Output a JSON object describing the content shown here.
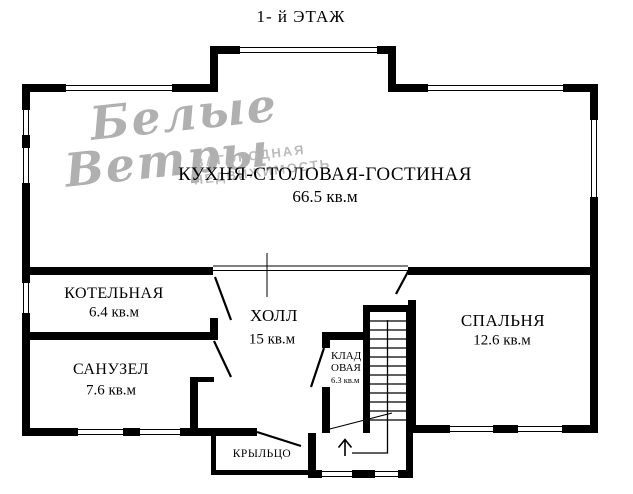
{
  "title": "1- й ЭТАЖ",
  "watermark": {
    "script_line1": "Белые",
    "script_line2": "Ветры",
    "caption_line1": "ЗАГОРОДНАЯ",
    "caption_line2": "НЕДВИЖИМОСТЬ"
  },
  "rooms": {
    "living": {
      "name": "КУХНЯ-СТОЛОВАЯ-ГОСТИНАЯ",
      "area": "66.5 кв.м"
    },
    "boiler": {
      "name": "КОТЕЛЬНАЯ",
      "area": "6.4 кв.м"
    },
    "bathroom": {
      "name": "САНУЗЕЛ",
      "area": "7.6 кв.м"
    },
    "hall": {
      "name": "ХОЛЛ",
      "area": "15 кв.м"
    },
    "storage": {
      "name_line1": "КЛАД",
      "name_line2": "ОВАЯ",
      "area": "6.3 кв.м"
    },
    "bedroom": {
      "name": "СПАЛЬНЯ",
      "area": "12.6 кв.м"
    },
    "porch": {
      "name": "КРЫЛЬЦО"
    }
  },
  "colors": {
    "walls": "#000000",
    "watermark": "#9d9d9d",
    "background": "#ffffff"
  }
}
